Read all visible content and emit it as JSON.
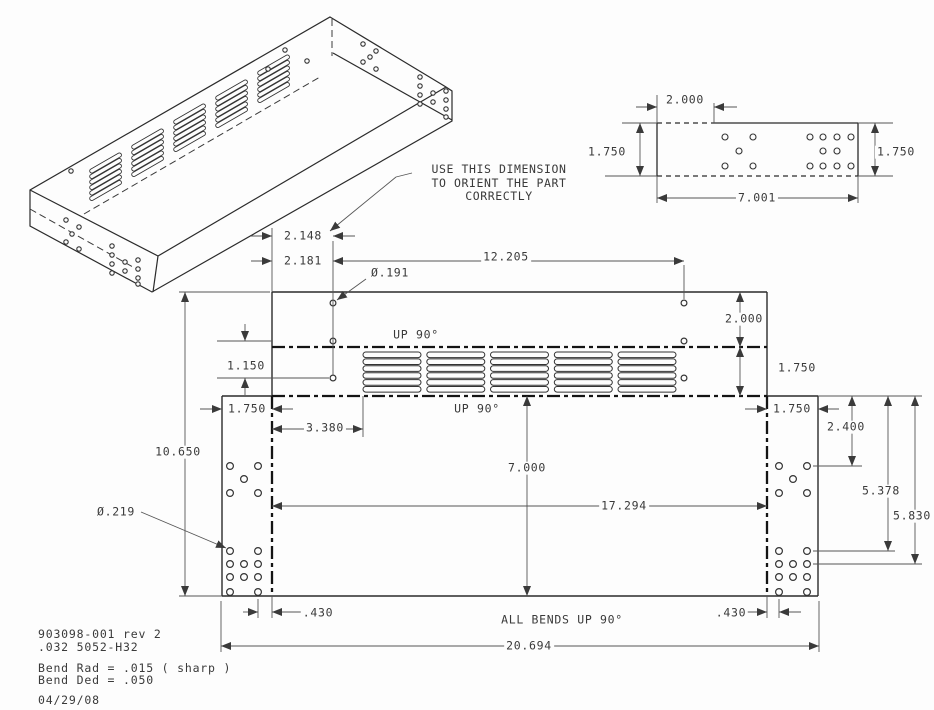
{
  "drawing": {
    "background_color": "#fdfdfd",
    "line_color": "#3a3a3a",
    "note": {
      "line1": "USE THIS DIMENSION",
      "line2": "TO ORIENT THE PART",
      "line3": "CORRECTLY"
    },
    "title_block": {
      "part_number": "903098-001 rev 2",
      "material": ".032 5052-H32",
      "bend_rad": "Bend Rad = .015 ( sharp )",
      "bend_ded": "Bend Ded = .050",
      "date": "04/29/08"
    },
    "dim_labels": [
      {
        "name": "dim-2-148",
        "text": "2.148",
        "x": 303,
        "y": 236
      },
      {
        "name": "dim-2-181",
        "text": "2.181",
        "x": 303,
        "y": 261
      },
      {
        "name": "dim-12-205",
        "text": "12.205",
        "x": 506,
        "y": 257
      },
      {
        "name": "dia-0-191",
        "text": "Ø.191",
        "x": 390,
        "y": 273
      },
      {
        "name": "dim-2-000-flat",
        "text": "2.000",
        "x": 744,
        "y": 319
      },
      {
        "name": "bend-note-up90-top",
        "text": "UP 90°",
        "x": 416,
        "y": 335
      },
      {
        "name": "dim-1-150",
        "text": "1.150",
        "x": 246,
        "y": 366
      },
      {
        "name": "dim-1-750-vent",
        "text": "1.750",
        "x": 797,
        "y": 368
      },
      {
        "name": "dim-1-750-left-tab",
        "text": "1.750",
        "x": 247,
        "y": 409
      },
      {
        "name": "bend-note-up90-bottom",
        "text": "UP 90°",
        "x": 477,
        "y": 409
      },
      {
        "name": "dim-1-750-right-tab",
        "text": "1.750",
        "x": 792,
        "y": 409
      },
      {
        "name": "dim-3-380",
        "text": "3.380",
        "x": 325,
        "y": 428
      },
      {
        "name": "dim-2-400",
        "text": "2.400",
        "x": 846,
        "y": 427
      },
      {
        "name": "dim-10-650",
        "text": "10.650",
        "x": 178,
        "y": 452
      },
      {
        "name": "dim-7-000",
        "text": "7.000",
        "x": 527,
        "y": 468
      },
      {
        "name": "dim-5-378",
        "text": "5.378",
        "x": 881,
        "y": 491
      },
      {
        "name": "dim-17-294",
        "text": "17.294",
        "x": 624,
        "y": 506
      },
      {
        "name": "dia-0-219",
        "text": "Ø.219",
        "x": 116,
        "y": 512
      },
      {
        "name": "dim-5-830",
        "text": "5.830",
        "x": 912,
        "y": 516
      },
      {
        "name": "dim-0-430-left",
        "text": ".430",
        "x": 318,
        "y": 613
      },
      {
        "name": "dim-0-430-right",
        "text": ".430",
        "x": 731,
        "y": 613
      },
      {
        "name": "note-all-bends",
        "text": "ALL BENDS UP 90°",
        "x": 562,
        "y": 620
      },
      {
        "name": "dim-20-694",
        "text": "20.694",
        "x": 529,
        "y": 646
      },
      {
        "name": "dim-2-000-detail",
        "text": "2.000",
        "x": 685,
        "y": 100
      },
      {
        "name": "dim-1-750-detail-left",
        "text": "1.750",
        "x": 607,
        "y": 152
      },
      {
        "name": "dim-1-750-detail-right",
        "text": "1.750",
        "x": 896,
        "y": 152
      },
      {
        "name": "dim-7-001",
        "text": "7.001",
        "x": 757,
        "y": 198
      }
    ]
  }
}
